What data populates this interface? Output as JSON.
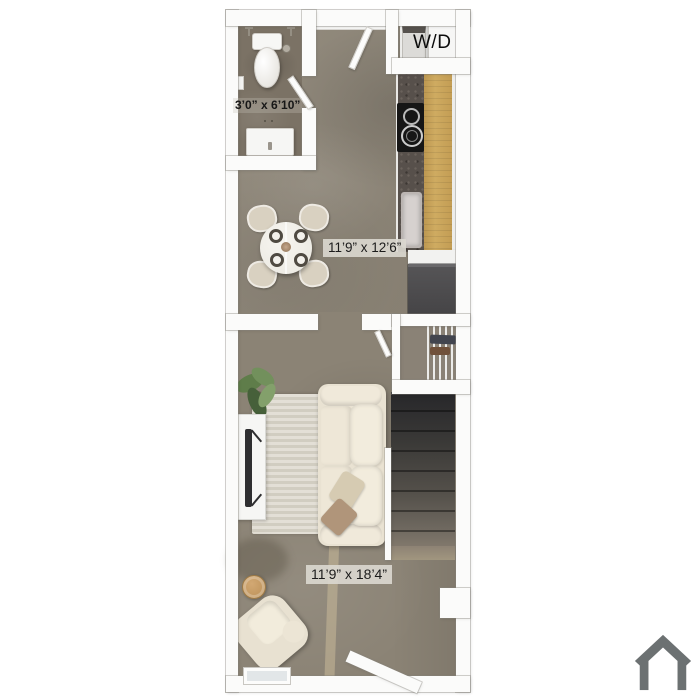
{
  "rooms": {
    "bathroom": {
      "dimensions": "3’0” x 6’10”"
    },
    "dining": {
      "dimensions": "11’9” x 12’6”"
    },
    "living": {
      "dimensions": "11’9” x 18’4”"
    },
    "laundry": {
      "label": "W/D"
    }
  },
  "icons": {
    "house_logo": "house-outline"
  },
  "colors": {
    "background": "#ffffff",
    "wall": "#fbfbfa",
    "floor_main": "#8c8476",
    "floor_bathroom": "#7b7265",
    "counter_wood": "#c8a45b",
    "countertop_granite": "#57504b",
    "cooktop": "#161616",
    "refrigerator": "#4b4a4c",
    "stairs_top": "#27272a",
    "stairs_bottom": "#8d8274",
    "sofa": "#e9e2d2",
    "throw_pillow": "#b0957a",
    "rug": "#dcd8cc",
    "plant": "#5f7d4a",
    "side_table_wood": "#c79d6a",
    "dimension_text": "#1b1b1b",
    "dimension_chip": "#dbd8d0",
    "logo_gray": "#6c7172"
  }
}
